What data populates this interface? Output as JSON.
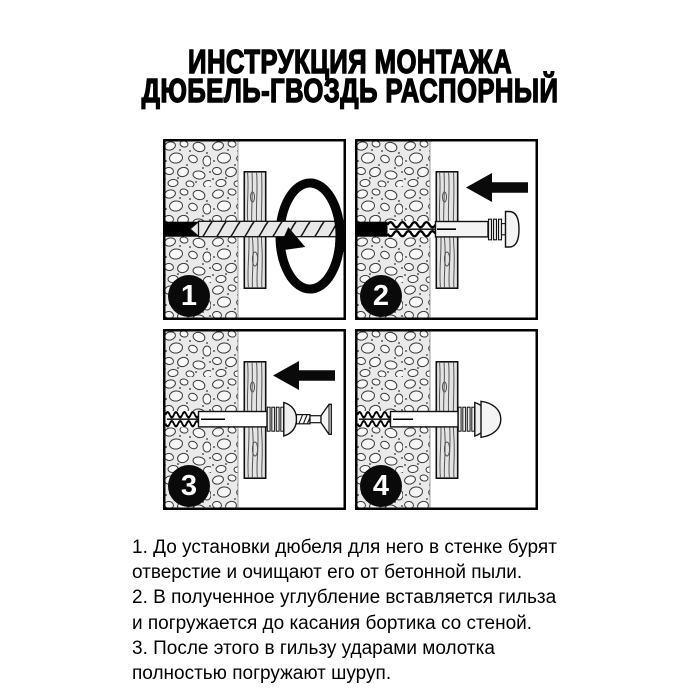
{
  "title": {
    "line1": "ИНСТРУКЦИЯ МОНТАЖА",
    "line2": "ДЮБЕЛЬ-ГВОЗДЬ РАСПОРНЫЙ"
  },
  "panels": [
    {
      "number": "1",
      "icon": "rotate-arrow"
    },
    {
      "number": "2",
      "icon": "left-arrow"
    },
    {
      "number": "3",
      "icon": "left-arrow"
    },
    {
      "number": "4",
      "icon": ""
    }
  ],
  "instructions": {
    "lines": [
      "1. До установки дюбеля для него в стенке бурят",
      "отверстие и очищают его от бетонной пыли.",
      "2. В полученное углубление вставляется гильза",
      "и погружается до касания бортика со стеной.",
      "3. После этого в гильзу ударами молотка",
      "полностью погружают шуруп."
    ]
  },
  "colors": {
    "ink": "#000000",
    "paper": "#ffffff",
    "concrete": "#eaeaea",
    "wood": "#e4e4e4",
    "metal": "#f0f0f0",
    "badge": "#0a0a0a"
  }
}
